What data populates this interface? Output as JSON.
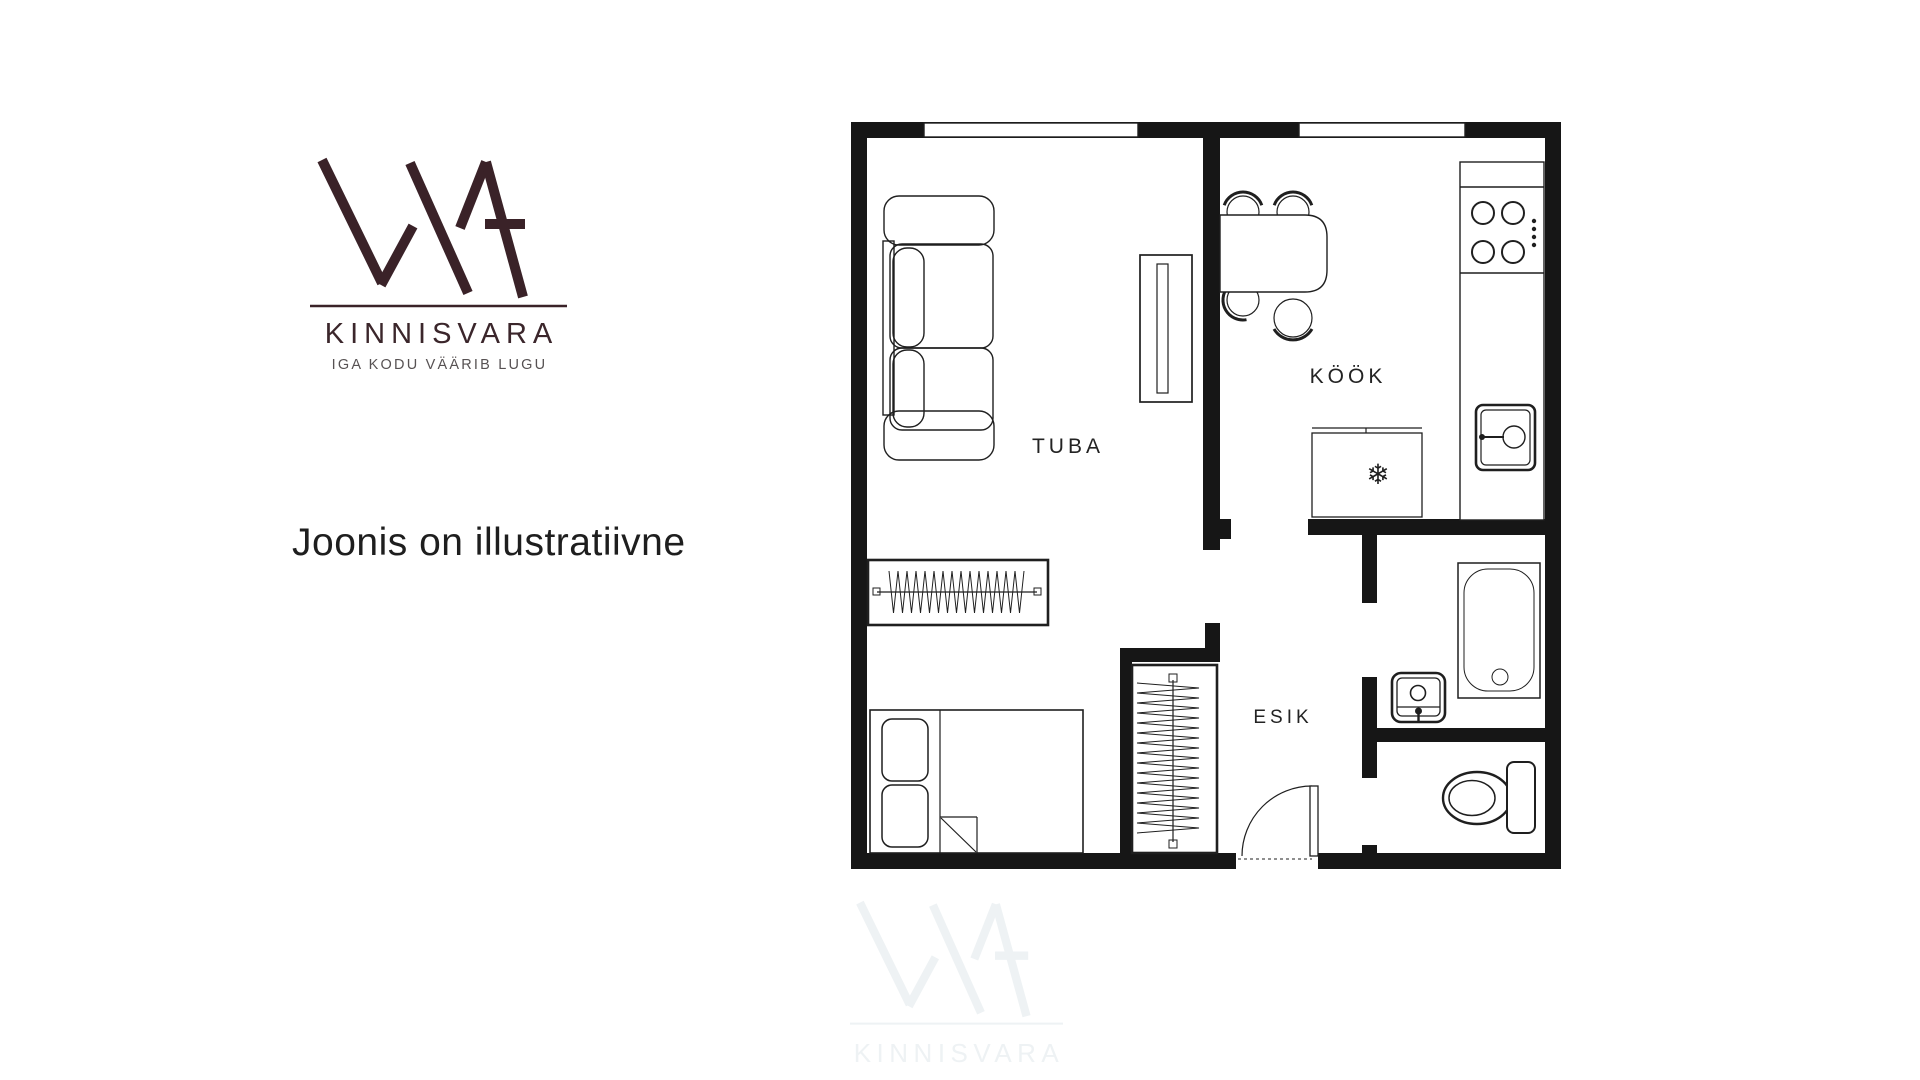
{
  "branding": {
    "logo_text": "KINNISVARA",
    "tagline": "IGA KODU VÄÄRIB LUGU",
    "logo_color": "#3a2228",
    "wordmark_color": "#3b262b",
    "tagline_color": "#575253"
  },
  "note": {
    "text": "Joonis on illustratiivne",
    "color": "#1e1e1e"
  },
  "floor_plan": {
    "wall_color": "#161616",
    "line_color": "#1f1f1f",
    "rooms": [
      {
        "label": "TUBA"
      },
      {
        "label": "KÖÖK"
      },
      {
        "label": "ESIK"
      }
    ],
    "icons": {
      "snowflake": "❄",
      "fixture_names": [
        "sofa-icon",
        "tv-bench-icon",
        "closet-icon",
        "bed-icon",
        "wardrobe-icon",
        "dining-table-icon",
        "chair-icon",
        "stove-icon",
        "kitchen-sink-icon",
        "fridge-icon",
        "bathtub-icon",
        "washbasin-icon",
        "toilet-icon",
        "entry-door-icon",
        "window-icon"
      ]
    }
  },
  "watermark": {
    "logo_text": "KINNISVARA",
    "color": "#eef2f4"
  }
}
